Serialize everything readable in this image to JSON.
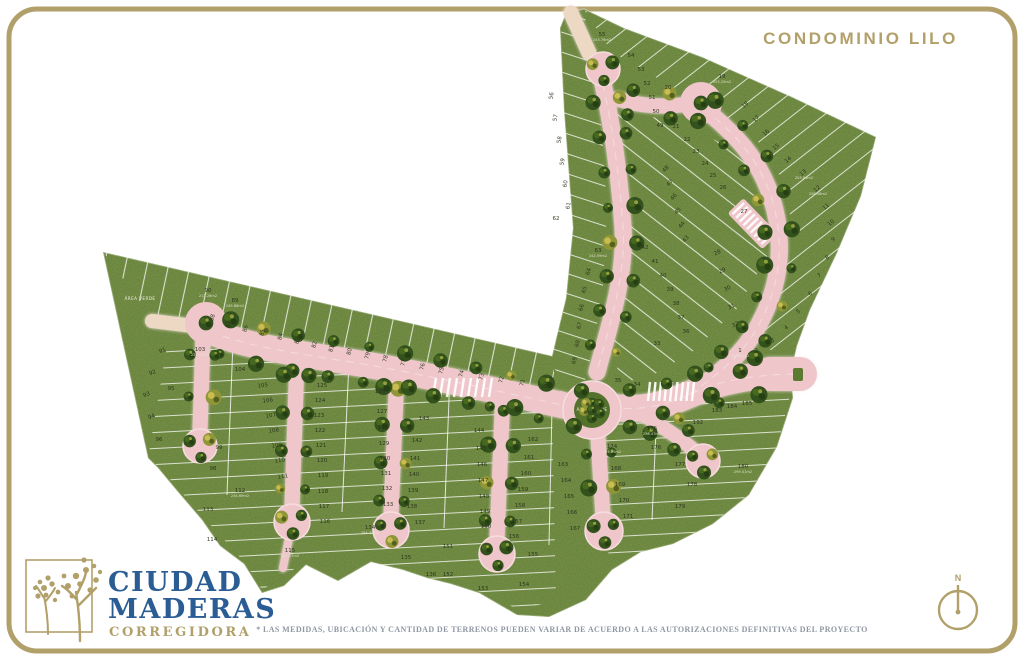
{
  "header": {
    "title": "CONDOMINIO LILO"
  },
  "logo": {
    "name_line1": "CIUDAD",
    "name_line2": "MADERAS",
    "location": "CORREGIDORA"
  },
  "footer": {
    "disclaimer": "* LAS MEDIDAS, UBICACIÓN Y CANTIDAD DE TERRENOS PUEDEN VARIAR DE ACUERDO A LAS AUTORIZACIONES DEFINITIVAS DEL PROYECTO"
  },
  "compass": {
    "north_label": "N"
  },
  "map": {
    "green_area_label": "ÁREA VERDE",
    "colors": {
      "accent_gold": "#b2a06a",
      "brand_blue": "#2a5d93",
      "road_pink": "#efc6ca",
      "road_cream": "#ecd8c3",
      "grass_green": "#5d7a31",
      "text_gray": "#8e97a3"
    },
    "lots": [
      [
        55,
        602,
        36,
        null,
        "243.76m2"
      ],
      [
        54,
        631,
        57
      ],
      [
        53,
        641,
        71
      ],
      [
        52,
        647,
        85
      ],
      [
        51,
        652,
        99
      ],
      [
        50,
        656,
        113
      ],
      [
        49,
        660,
        127
      ],
      [
        19,
        722,
        78,
        null,
        "253.25m2"
      ],
      [
        20,
        668,
        89
      ],
      [
        18,
        746,
        106,
        -40
      ],
      [
        17,
        757,
        120,
        -40
      ],
      [
        16,
        767,
        134,
        -40
      ],
      [
        15,
        777,
        148,
        -40
      ],
      [
        14,
        789,
        161,
        -40
      ],
      [
        13,
        804,
        174,
        -40,
        "203.84m2"
      ],
      [
        12,
        818,
        190,
        -40,
        "256.06m2"
      ],
      [
        11,
        827,
        208,
        -40
      ],
      [
        10,
        832,
        224,
        -40
      ],
      [
        9,
        834,
        241,
        -30
      ],
      [
        8,
        828,
        259,
        -30
      ],
      [
        7,
        820,
        277,
        -30
      ],
      [
        6,
        811,
        295,
        -30
      ],
      [
        5,
        799,
        313,
        -30
      ],
      [
        4,
        787,
        329,
        -30
      ],
      [
        3,
        773,
        342,
        -20
      ],
      [
        2,
        757,
        352,
        -15
      ],
      [
        1,
        740,
        352,
        0,
        "162.82m2"
      ],
      [
        28,
        718,
        254,
        -25
      ],
      [
        29,
        723,
        272,
        -25
      ],
      [
        30,
        728,
        290,
        -25
      ],
      [
        31,
        732,
        308,
        -25
      ],
      [
        32,
        736,
        326,
        -25
      ],
      [
        33,
        657,
        345
      ],
      [
        34,
        637,
        386
      ],
      [
        35,
        618,
        382
      ],
      [
        48,
        667,
        170,
        -50
      ],
      [
        47,
        671,
        184,
        -50
      ],
      [
        46,
        675,
        198,
        -50
      ],
      [
        45,
        679,
        212,
        -50
      ],
      [
        44,
        683,
        226,
        -50
      ],
      [
        43,
        687,
        240,
        -50
      ],
      [
        42,
        645,
        249
      ],
      [
        41,
        655,
        263
      ],
      [
        40,
        663,
        277
      ],
      [
        39,
        670,
        291
      ],
      [
        38,
        676,
        305
      ],
      [
        37,
        681,
        319
      ],
      [
        36,
        686,
        333
      ],
      [
        21,
        676,
        128
      ],
      [
        22,
        687,
        141
      ],
      [
        23,
        696,
        153
      ],
      [
        24,
        705,
        165
      ],
      [
        25,
        713,
        177
      ],
      [
        26,
        723,
        189
      ],
      [
        27,
        744,
        213
      ],
      [
        56,
        553,
        96,
        -80
      ],
      [
        57,
        557,
        118,
        -80
      ],
      [
        58,
        561,
        140,
        -80
      ],
      [
        59,
        564,
        162,
        -80
      ],
      [
        60,
        567,
        184,
        -80
      ],
      [
        61,
        570,
        206,
        -80
      ],
      [
        62,
        556,
        220
      ],
      [
        63,
        598,
        252,
        null,
        "242.59m2"
      ],
      [
        64,
        590,
        272,
        -75
      ],
      [
        65,
        586,
        290,
        -75
      ],
      [
        66,
        583,
        308,
        -75
      ],
      [
        67,
        581,
        326,
        -75
      ],
      [
        68,
        579,
        344,
        -75
      ],
      [
        69,
        576,
        361,
        -75
      ],
      [
        70,
        547,
        386,
        -75
      ],
      [
        71,
        524,
        383,
        -75
      ],
      [
        72,
        503,
        380,
        -75
      ],
      [
        73,
        483,
        377,
        -75
      ],
      [
        74,
        463,
        374,
        -75
      ],
      [
        75,
        443,
        371,
        -75
      ],
      [
        76,
        424,
        367,
        -75
      ],
      [
        77,
        405,
        363,
        -75
      ],
      [
        78,
        387,
        359,
        -75
      ],
      [
        79,
        369,
        356,
        -75
      ],
      [
        80,
        351,
        352,
        -75
      ],
      [
        81,
        333,
        349,
        -75
      ],
      [
        82,
        316,
        345,
        -75
      ],
      [
        83,
        299,
        341,
        -75
      ],
      [
        84,
        282,
        337,
        -75
      ],
      [
        85,
        264,
        333,
        -75
      ],
      [
        86,
        247,
        329,
        -75
      ],
      [
        87,
        230,
        325,
        -75
      ],
      [
        88,
        214,
        318,
        -75
      ],
      [
        89,
        235,
        302,
        0,
        "245.86m2"
      ],
      [
        90,
        208,
        292,
        0,
        "213.28m2"
      ],
      [
        91,
        163,
        352,
        -20
      ],
      [
        92,
        153,
        374,
        -20
      ],
      [
        93,
        147,
        396,
        -20
      ],
      [
        94,
        152,
        418,
        -20
      ],
      [
        95,
        171,
        390
      ],
      [
        96,
        159,
        441
      ],
      [
        98,
        213,
        470
      ],
      [
        99,
        219,
        449
      ],
      [
        103,
        200,
        351,
        0,
        "229.63m2"
      ],
      [
        104,
        240,
        371
      ],
      [
        105,
        263,
        387,
        -8
      ],
      [
        106,
        268,
        402,
        -8
      ],
      [
        107,
        271,
        417,
        -8
      ],
      [
        108,
        274,
        432,
        -8
      ],
      [
        109,
        277,
        447,
        -8
      ],
      [
        110,
        280,
        462,
        -8
      ],
      [
        111,
        283,
        478,
        -8
      ],
      [
        112,
        240,
        492,
        0,
        "234.69m2"
      ],
      [
        113,
        208,
        511
      ],
      [
        114,
        212,
        541
      ],
      [
        115,
        290,
        552,
        0,
        "407.57m2"
      ],
      [
        116,
        325,
        523
      ],
      [
        117,
        324,
        508
      ],
      [
        118,
        323,
        493
      ],
      [
        119,
        323,
        477
      ],
      [
        120,
        322,
        462
      ],
      [
        121,
        321,
        447
      ],
      [
        122,
        320,
        432
      ],
      [
        123,
        319,
        417
      ],
      [
        124,
        320,
        402
      ],
      [
        125,
        322,
        387
      ],
      [
        126,
        380,
        393
      ],
      [
        127,
        382,
        413
      ],
      [
        128,
        383,
        429
      ],
      [
        129,
        384,
        445
      ],
      [
        130,
        385,
        460
      ],
      [
        131,
        386,
        475
      ],
      [
        132,
        387,
        490
      ],
      [
        133,
        388,
        506
      ],
      [
        134,
        370,
        529,
        0,
        "284.32m2"
      ],
      [
        135,
        406,
        559
      ],
      [
        136,
        431,
        576
      ],
      [
        137,
        420,
        524
      ],
      [
        138,
        412,
        508
      ],
      [
        139,
        413,
        492
      ],
      [
        140,
        414,
        476
      ],
      [
        141,
        415,
        460
      ],
      [
        142,
        417,
        442
      ],
      [
        143,
        424,
        420
      ],
      [
        144,
        479,
        432
      ],
      [
        145,
        481,
        450
      ],
      [
        146,
        482,
        466
      ],
      [
        147,
        483,
        482
      ],
      [
        148,
        484,
        498
      ],
      [
        149,
        485,
        513
      ],
      [
        150,
        486,
        528
      ],
      [
        151,
        448,
        548
      ],
      [
        152,
        448,
        576
      ],
      [
        153,
        483,
        590
      ],
      [
        154,
        524,
        586
      ],
      [
        155,
        533,
        556
      ],
      [
        156,
        514,
        538
      ],
      [
        157,
        517,
        523
      ],
      [
        158,
        520,
        507
      ],
      [
        159,
        523,
        491
      ],
      [
        160,
        526,
        475
      ],
      [
        161,
        529,
        459
      ],
      [
        162,
        533,
        441
      ],
      [
        163,
        563,
        466
      ],
      [
        164,
        566,
        482
      ],
      [
        165,
        569,
        498
      ],
      [
        166,
        572,
        514
      ],
      [
        167,
        575,
        530
      ],
      [
        168,
        616,
        470
      ],
      [
        169,
        620,
        486
      ],
      [
        170,
        624,
        502
      ],
      [
        171,
        628,
        518
      ],
      [
        174,
        612,
        448,
        0,
        "165.80m2"
      ],
      [
        175,
        652,
        430,
        0,
        "256.47m2"
      ],
      [
        176,
        656,
        449
      ],
      [
        177,
        680,
        466
      ],
      [
        178,
        692,
        486
      ],
      [
        179,
        680,
        508
      ],
      [
        180,
        743,
        468,
        0,
        "299.01m2"
      ],
      [
        183,
        717,
        412
      ],
      [
        184,
        732,
        408
      ],
      [
        185,
        747,
        405
      ],
      [
        192,
        698,
        424
      ]
    ]
  }
}
